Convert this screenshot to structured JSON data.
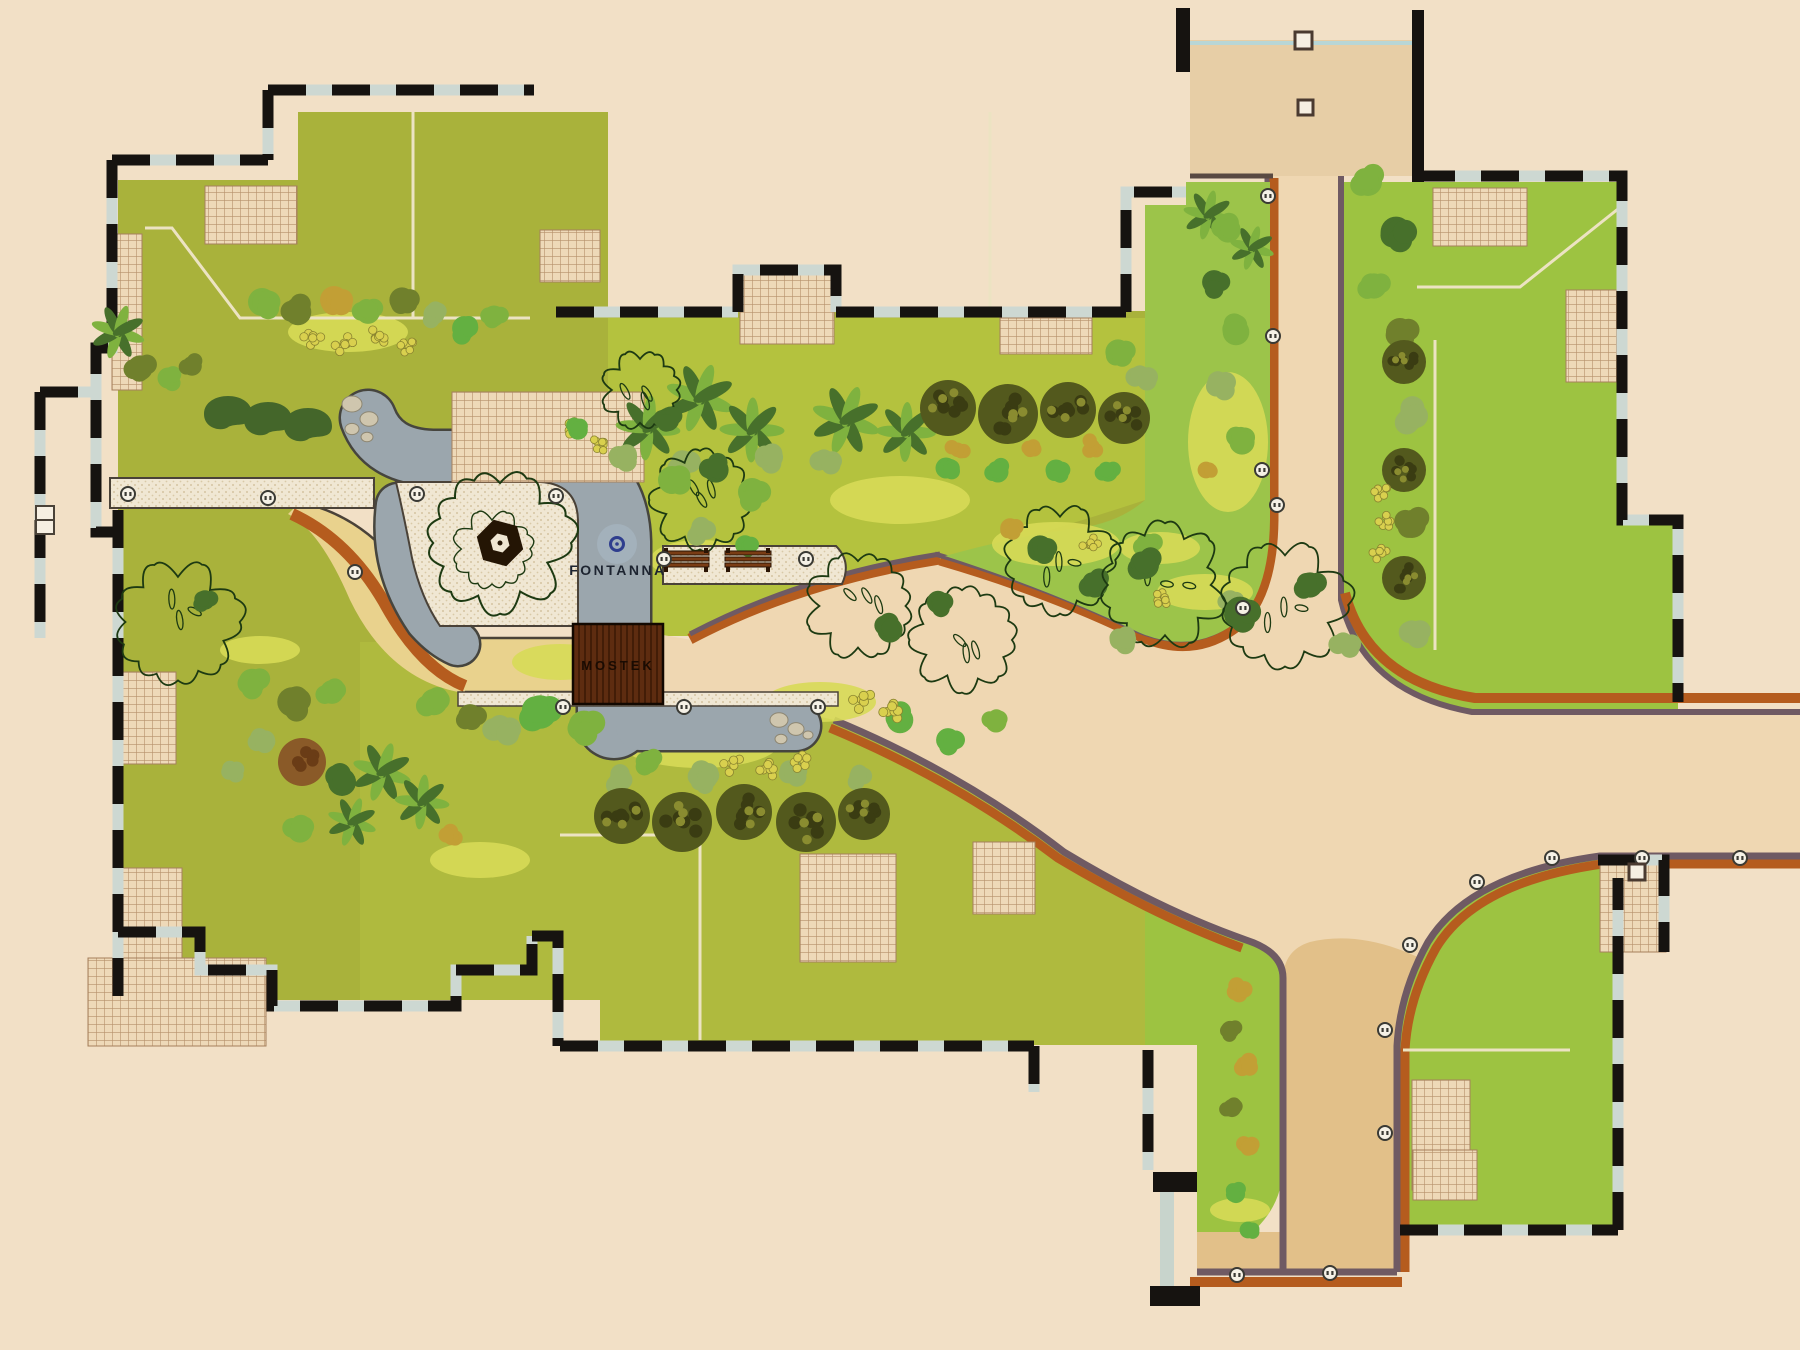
{
  "labels": {
    "fountain": "FONTANNA",
    "bridge": "MOSTEK"
  },
  "colors": {
    "bg": "#f2e0c6",
    "lawnOlive": "#a9b23b",
    "lawnCenter": "#b4c23e",
    "lawnBright": "#9dc341",
    "wedgeGreen": "#9cc44a",
    "patchYellow": "#d7da57",
    "roadTan": "#efd7b2",
    "roadDark": "#e2c089",
    "plazaTan": "#e7cea6",
    "roadYellow": "#e9d28d",
    "edgeOrange": "#b55c1e",
    "edgePurple": "#6f5a63",
    "gray": "#9ba6ad",
    "grayStroke": "#46453e",
    "cream": "#f0e7d3",
    "dot": "#d5c4a1",
    "outline": "#4a4238",
    "hatchBase": "#eed9b8",
    "hatchLine": "#b5906a",
    "wall": "#161310",
    "wallLight": "#cdd8d2",
    "bridge": "#5e2c10",
    "bridgeDark": "#431d07",
    "fountainBlue": "#2f3e8e",
    "fountainHalo": "#aab9c6",
    "treeBright": "#63b041",
    "treeMid": "#7fb23f",
    "treeSage": "#97b261",
    "treeDark": "#47702b",
    "treeOlive": "#70802c",
    "treeDeep": "#53591d",
    "treeGold": "#c29f35",
    "treeYellow": "#d9d04e",
    "crown": "#1d3a12",
    "brown": "#8a5a28",
    "rock": "#cfc6ae",
    "benchBrown": "#7a3c14",
    "blueLine": "#b8d6d6"
  },
  "trees": [
    [
      140,
      368,
      18,
      "b_olive"
    ],
    [
      168,
      378,
      15,
      "b_mid"
    ],
    [
      192,
      366,
      14,
      "b_olive"
    ],
    [
      118,
      332,
      22,
      "p"
    ],
    [
      228,
      414,
      24,
      "k"
    ],
    [
      268,
      420,
      24,
      "k"
    ],
    [
      308,
      426,
      24,
      "k"
    ],
    [
      262,
      302,
      20,
      "b_mid"
    ],
    [
      298,
      312,
      19,
      "b_olive"
    ],
    [
      334,
      300,
      20,
      "b_gold"
    ],
    [
      368,
      312,
      17,
      "b_mid"
    ],
    [
      402,
      300,
      18,
      "b_olive"
    ],
    [
      434,
      314,
      15,
      "b_sage"
    ],
    [
      464,
      328,
      17,
      "b_bright"
    ],
    [
      494,
      316,
      15,
      "b_mid"
    ],
    [
      312,
      338,
      11,
      "y"
    ],
    [
      344,
      344,
      11,
      "y"
    ],
    [
      376,
      338,
      11,
      "y"
    ],
    [
      406,
      346,
      10,
      "y"
    ],
    [
      648,
      428,
      26,
      "p"
    ],
    [
      700,
      398,
      28,
      "p"
    ],
    [
      752,
      430,
      26,
      "p"
    ],
    [
      846,
      420,
      28,
      "p"
    ],
    [
      906,
      432,
      24,
      "p"
    ],
    [
      620,
      458,
      17,
      "s"
    ],
    [
      682,
      462,
      18,
      "s"
    ],
    [
      766,
      458,
      17,
      "s"
    ],
    [
      826,
      462,
      16,
      "s"
    ],
    [
      572,
      430,
      11,
      "y"
    ],
    [
      598,
      445,
      10,
      "y"
    ],
    [
      948,
      408,
      28,
      "d"
    ],
    [
      1008,
      414,
      30,
      "d"
    ],
    [
      1068,
      410,
      28,
      "d"
    ],
    [
      1124,
      418,
      26,
      "d"
    ],
    [
      958,
      448,
      13,
      "g"
    ],
    [
      1028,
      450,
      13,
      "g"
    ],
    [
      1092,
      446,
      13,
      "g"
    ],
    [
      946,
      468,
      15,
      "b_bright"
    ],
    [
      998,
      472,
      15,
      "b_bright"
    ],
    [
      1056,
      470,
      15,
      "b_bright"
    ],
    [
      1108,
      472,
      14,
      "b_bright"
    ],
    [
      1118,
      352,
      18,
      "b_mid"
    ],
    [
      1142,
      378,
      16,
      "s"
    ],
    [
      640,
      390,
      34,
      "o"
    ],
    [
      700,
      500,
      44,
      "o"
    ],
    [
      668,
      420,
      16,
      "b_dark"
    ],
    [
      672,
      480,
      20,
      "b_mid"
    ],
    [
      716,
      470,
      18,
      "b_dark"
    ],
    [
      752,
      492,
      20,
      "b_mid"
    ],
    [
      700,
      530,
      16,
      "s"
    ],
    [
      745,
      545,
      14,
      "b_bright"
    ],
    [
      578,
      430,
      14,
      "b_bright"
    ],
    [
      1060,
      560,
      48,
      "o"
    ],
    [
      1095,
      585,
      18,
      "b_dark"
    ],
    [
      1040,
      548,
      18,
      "b_dark"
    ],
    [
      1148,
      545,
      16,
      "b_mid"
    ],
    [
      1010,
      528,
      14,
      "b_gold"
    ],
    [
      1090,
      545,
      10,
      "y"
    ],
    [
      1160,
      600,
      10,
      "y"
    ],
    [
      1230,
      600,
      14,
      "b_sage"
    ],
    [
      1208,
      215,
      20,
      "p"
    ],
    [
      1252,
      248,
      18,
      "p"
    ],
    [
      1228,
      230,
      18,
      "b_mid"
    ],
    [
      1214,
      282,
      17,
      "b_dark"
    ],
    [
      1236,
      332,
      19,
      "b_mid"
    ],
    [
      1220,
      386,
      17,
      "s"
    ],
    [
      1242,
      442,
      18,
      "b_mid"
    ],
    [
      1206,
      470,
      12,
      "b_gold"
    ],
    [
      1368,
      182,
      20,
      "b_mid"
    ],
    [
      1396,
      232,
      22,
      "b_dark"
    ],
    [
      1374,
      286,
      18,
      "b_mid"
    ],
    [
      1400,
      332,
      20,
      "b_olive"
    ],
    [
      1404,
      362,
      22,
      "d"
    ],
    [
      1410,
      416,
      20,
      "s"
    ],
    [
      1404,
      470,
      22,
      "d"
    ],
    [
      1412,
      524,
      20,
      "b_olive"
    ],
    [
      1404,
      578,
      22,
      "d"
    ],
    [
      1412,
      632,
      18,
      "s"
    ],
    [
      1380,
      492,
      10,
      "y"
    ],
    [
      1384,
      522,
      10,
      "y"
    ],
    [
      1380,
      552,
      10,
      "y"
    ],
    [
      1165,
      585,
      55,
      "o"
    ],
    [
      1285,
      605,
      55,
      "o"
    ],
    [
      1145,
      565,
      20,
      "b_dark"
    ],
    [
      1240,
      612,
      22,
      "b_dark"
    ],
    [
      1310,
      585,
      18,
      "b_dark"
    ],
    [
      1120,
      640,
      16,
      "s"
    ],
    [
      1345,
      645,
      16,
      "s"
    ],
    [
      618,
      780,
      16,
      "s"
    ],
    [
      704,
      776,
      17,
      "s"
    ],
    [
      792,
      774,
      16,
      "s"
    ],
    [
      858,
      776,
      14,
      "s"
    ],
    [
      622,
      816,
      28,
      "d"
    ],
    [
      682,
      822,
      30,
      "d"
    ],
    [
      744,
      812,
      28,
      "d"
    ],
    [
      806,
      822,
      30,
      "d"
    ],
    [
      864,
      814,
      26,
      "d"
    ],
    [
      732,
      764,
      11,
      "y"
    ],
    [
      766,
      770,
      11,
      "y"
    ],
    [
      800,
      762,
      11,
      "y"
    ],
    [
      540,
      712,
      24,
      "b_bright"
    ],
    [
      584,
      726,
      22,
      "b_mid"
    ],
    [
      502,
      730,
      19,
      "s"
    ],
    [
      434,
      702,
      19,
      "b_mid"
    ],
    [
      470,
      716,
      17,
      "b_olive"
    ],
    [
      858,
      606,
      46,
      "o"
    ],
    [
      962,
      640,
      46,
      "o"
    ],
    [
      890,
      630,
      18,
      "b_dark"
    ],
    [
      938,
      602,
      16,
      "b_dark"
    ],
    [
      900,
      720,
      19,
      "b_bright"
    ],
    [
      948,
      740,
      17,
      "b_bright"
    ],
    [
      996,
      722,
      15,
      "b_mid"
    ],
    [
      862,
      700,
      12,
      "y"
    ],
    [
      890,
      712,
      12,
      "y"
    ],
    [
      178,
      622,
      54,
      "o"
    ],
    [
      205,
      600,
      14,
      "b_dark"
    ],
    [
      252,
      682,
      19,
      "b_mid"
    ],
    [
      292,
      702,
      21,
      "b_olive"
    ],
    [
      332,
      692,
      17,
      "b_mid"
    ],
    [
      262,
      742,
      15,
      "s"
    ],
    [
      232,
      772,
      13,
      "s"
    ],
    [
      302,
      762,
      24,
      "brn"
    ],
    [
      342,
      782,
      20,
      "b_dark"
    ],
    [
      382,
      772,
      24,
      "p"
    ],
    [
      422,
      802,
      22,
      "p"
    ],
    [
      352,
      822,
      20,
      "p"
    ],
    [
      300,
      830,
      18,
      "b_mid"
    ],
    [
      448,
      838,
      14,
      "g"
    ],
    [
      648,
      762,
      16,
      "b_mid"
    ],
    [
      700,
      782,
      14,
      "s"
    ],
    [
      1240,
      992,
      15,
      "g"
    ],
    [
      1230,
      1030,
      13,
      "b_olive"
    ],
    [
      1246,
      1068,
      15,
      "g"
    ],
    [
      1232,
      1108,
      13,
      "b_olive"
    ],
    [
      1246,
      1148,
      14,
      "g"
    ],
    [
      1236,
      1194,
      13,
      "b_bright"
    ],
    [
      1248,
      1230,
      12,
      "b_bright"
    ]
  ],
  "gazebo": {
    "x": 500,
    "y": 543,
    "crownR": 62,
    "hexR": 24,
    "innerHexR": 11
  },
  "fountain": {
    "x": 617,
    "y": 544,
    "haloR": 20,
    "ringR": 6.5
  },
  "lamps": [
    [
      128,
      494
    ],
    [
      268,
      498
    ],
    [
      355,
      572
    ],
    [
      417,
      494
    ],
    [
      556,
      496
    ],
    [
      664,
      559
    ],
    [
      806,
      559
    ],
    [
      563,
      707
    ],
    [
      684,
      707
    ],
    [
      818,
      707
    ],
    [
      1268,
      196
    ],
    [
      1273,
      336
    ],
    [
      1262,
      470
    ],
    [
      1277,
      505
    ],
    [
      1243,
      608
    ],
    [
      1552,
      858
    ],
    [
      1642,
      858
    ],
    [
      1740,
      858
    ],
    [
      1477,
      882
    ],
    [
      1410,
      945
    ],
    [
      1385,
      1030
    ],
    [
      1385,
      1133
    ],
    [
      1330,
      1273
    ],
    [
      1237,
      1275
    ]
  ],
  "benches": [
    [
      686,
      560
    ],
    [
      748,
      560
    ]
  ],
  "squares": [
    [
      1295,
      32,
      17
    ],
    [
      1298,
      100,
      15
    ],
    [
      1629,
      864,
      16
    ]
  ],
  "tableIcon": [
    36,
    506,
    18,
    28
  ],
  "rocks": [
    [
      [
        352,
        404,
        10
      ],
      [
        369,
        419,
        9
      ],
      [
        352,
        429,
        7
      ],
      [
        367,
        437,
        6
      ]
    ],
    [
      [
        779,
        720,
        9
      ],
      [
        796,
        729,
        8
      ],
      [
        781,
        739,
        6
      ],
      [
        808,
        735,
        5
      ]
    ]
  ],
  "patches": [
    [
      348,
      332,
      60,
      20
    ],
    [
      900,
      500,
      70,
      24
    ],
    [
      700,
      560,
      50,
      20
    ],
    [
      1056,
      544,
      64,
      22
    ],
    [
      1205,
      592,
      48,
      18
    ],
    [
      1228,
      442,
      40,
      70
    ],
    [
      700,
      742,
      80,
      26
    ],
    [
      820,
      702,
      56,
      20
    ],
    [
      560,
      662,
      48,
      18
    ],
    [
      1160,
      548,
      40,
      16
    ],
    [
      620,
      690,
      40,
      16
    ],
    [
      260,
      650,
      40,
      14
    ],
    [
      480,
      860,
      50,
      18
    ],
    [
      1240,
      1210,
      30,
      12
    ]
  ],
  "hatches": [
    [
      205,
      186,
      92,
      58
    ],
    [
      112,
      234,
      30,
      156
    ],
    [
      452,
      392,
      192,
      90
    ],
    [
      540,
      230,
      60,
      52
    ],
    [
      118,
      672,
      58,
      92
    ],
    [
      122,
      868,
      60,
      96
    ],
    [
      88,
      958,
      178,
      88
    ],
    [
      740,
      272,
      94,
      72
    ],
    [
      1000,
      318,
      92,
      36
    ],
    [
      1433,
      188,
      94,
      58
    ],
    [
      1566,
      290,
      52,
      92
    ],
    [
      800,
      854,
      96,
      108
    ],
    [
      973,
      842,
      62,
      72
    ],
    [
      1600,
      862,
      66,
      90
    ],
    [
      1412,
      1080,
      58,
      110
    ],
    [
      1413,
      1150,
      64,
      50
    ]
  ]
}
